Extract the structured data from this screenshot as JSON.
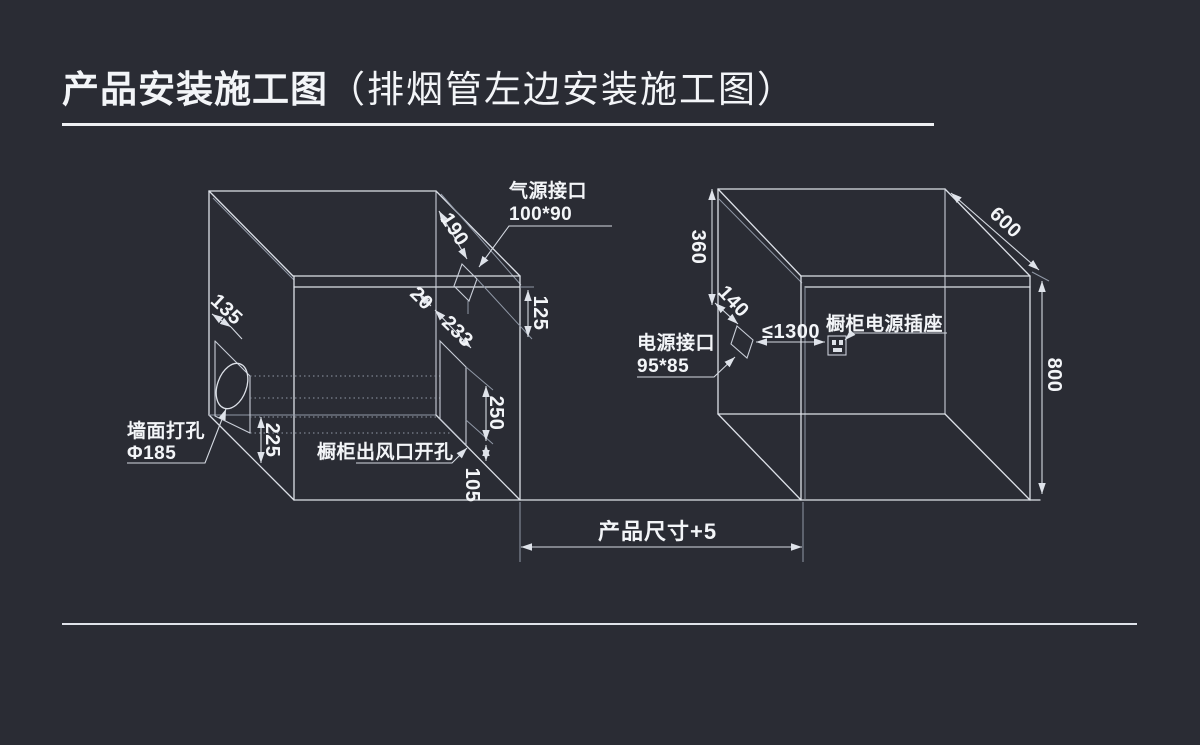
{
  "colors": {
    "background": "#2a2c34",
    "line": "#dde1e8",
    "line_soft": "#9098a6",
    "text": "#f3f5f8"
  },
  "title": {
    "main": "产品安装施工图",
    "sub": "（排烟管左边安装施工图）"
  },
  "left_cabinet": {
    "gas_port_label": "气源接口",
    "gas_port_size": "100*90",
    "wall_hole_label": "墙面打孔",
    "wall_hole_size": "Φ185",
    "outlet_label": "橱柜出风口开孔",
    "dims": {
      "d135": "135",
      "d190": "190",
      "d125": "125",
      "d20": "20",
      "d233": "233",
      "d250": "250",
      "d105": "105",
      "d225": "225"
    }
  },
  "right_cabinet": {
    "power_port_label": "电源接口",
    "power_port_size": "95*85",
    "socket_label": "橱柜电源插座",
    "dims": {
      "d360": "360",
      "d140": "140",
      "d600": "600",
      "d800": "800",
      "d1300": "≤1300"
    }
  },
  "bottom": {
    "product_size": "产品尺寸+5"
  }
}
